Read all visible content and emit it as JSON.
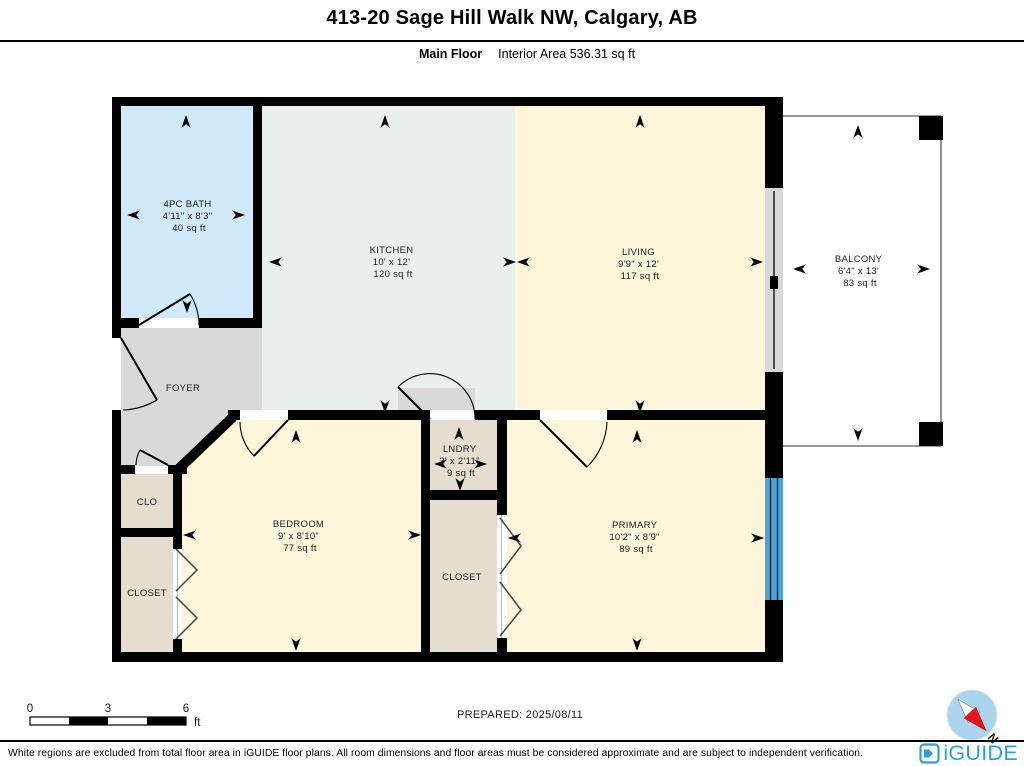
{
  "header": {
    "title": "413-20 Sage Hill Walk NW, Calgary, AB",
    "floor_label": "Main Floor",
    "area_label": "Interior Area 536.31 sq ft"
  },
  "rooms": {
    "bath": {
      "name": "4PC BATH",
      "dims": "4'11\" x 8'3\"",
      "area": "40 sq ft"
    },
    "kitchen": {
      "name": "KITCHEN",
      "dims": "10' x 12'",
      "area": "120 sq ft"
    },
    "living": {
      "name": "LIVING",
      "dims": "9'9\" x 12'",
      "area": "117 sq ft"
    },
    "balcony": {
      "name": "BALCONY",
      "dims": "6'4\" x 13'",
      "area": "83 sq ft"
    },
    "foyer": {
      "name": "FOYER"
    },
    "laundry": {
      "name": "LNDRY",
      "dims": "3' x 2'11\"",
      "area": "9 sq ft"
    },
    "bedroom": {
      "name": "BEDROOM",
      "dims": "9' x 8'10\"",
      "area": "77 sq ft"
    },
    "primary": {
      "name": "PRIMARY",
      "dims": "10'2\" x 8'9\"",
      "area": "89 sq ft"
    },
    "clo": {
      "name": "CLO"
    },
    "closet_left": {
      "name": "CLOSET"
    },
    "closet_middle": {
      "name": "CLOSET"
    }
  },
  "colors": {
    "bath": "#cfe9f8",
    "kitchen": "#e9efec",
    "living": "#fdf6da",
    "bedroom": "#fdf6da",
    "primary": "#fdf6da",
    "foyer": "#d9d9d9",
    "closet": "#e4ddd0",
    "laundry": "#e4ddd0",
    "balcony": "#ffffff",
    "window": "#4fa3d8",
    "wall": "#000000",
    "logo_blue": "#2b9fd6",
    "compass_face": "#abd4ef",
    "compass_needle_red": "#e11919"
  },
  "scale_bar": {
    "labels": [
      "0",
      "3",
      "6"
    ],
    "unit": "ft"
  },
  "footer": {
    "prepared": "PREPARED: 2025/08/11",
    "disclaimer": "White regions are excluded from total floor area in iGUIDE floor plans. All room dimensions and floor areas must be considered approximate and are subject to independent verification.",
    "brand": "iGUIDE",
    "compass_n": "N"
  }
}
